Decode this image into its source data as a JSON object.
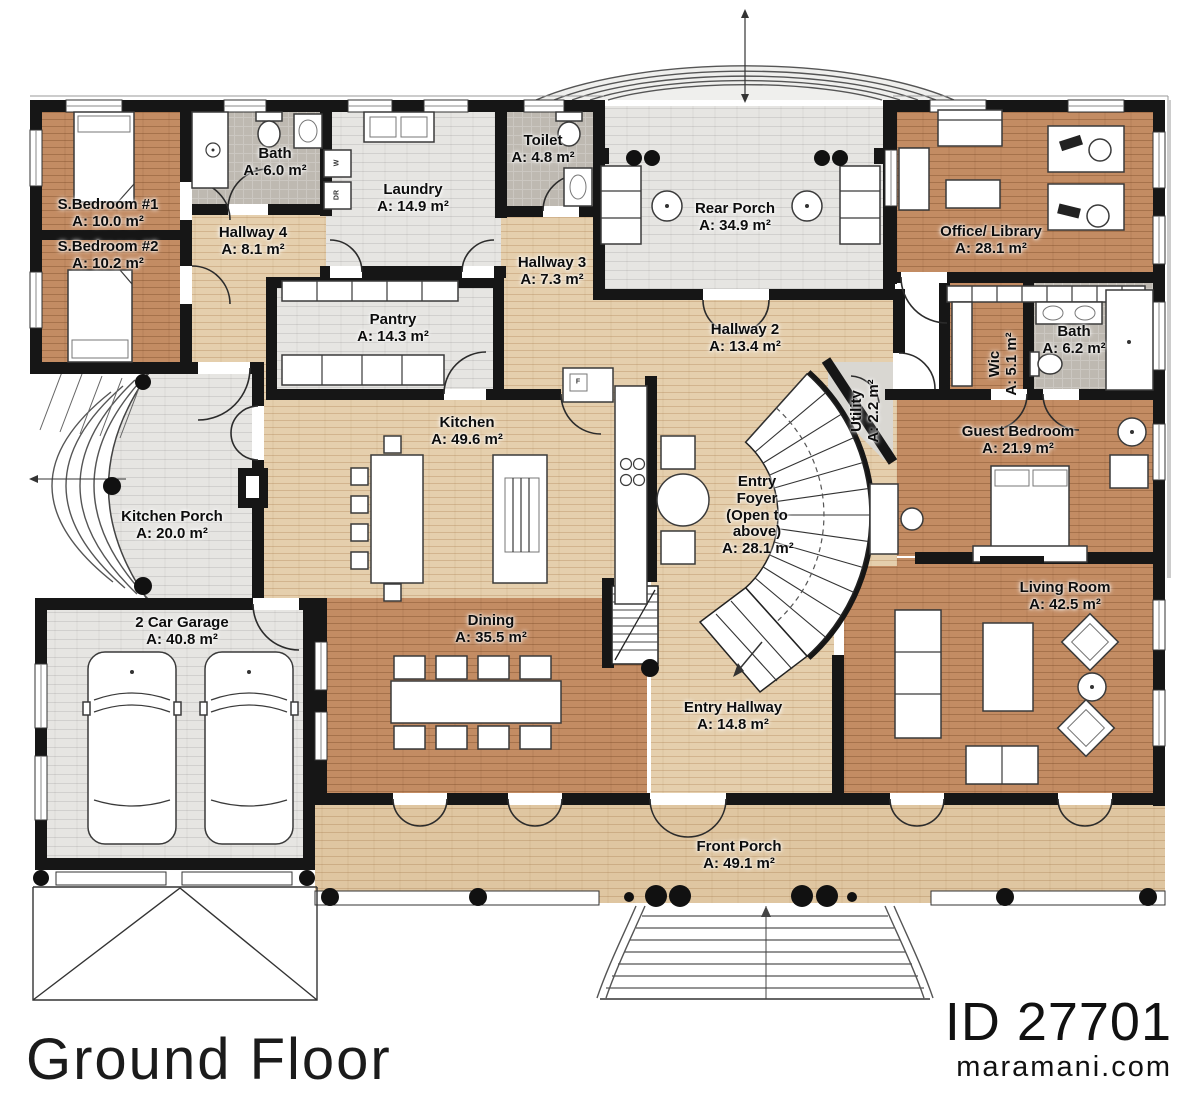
{
  "footer": {
    "title": "Ground Floor",
    "plan_id": "ID 27701",
    "website": "maramani.com"
  },
  "rooms": {
    "s_bedroom_1": {
      "name": "S.Bedroom #1",
      "area": "A: 10.0 m²"
    },
    "s_bedroom_2": {
      "name": "S.Bedroom #2",
      "area": "A: 10.2 m²"
    },
    "bath_1": {
      "name": "Bath",
      "area": "A: 6.0 m²"
    },
    "hallway_4": {
      "name": "Hallway 4",
      "area": "A: 8.1 m²"
    },
    "laundry": {
      "name": "Laundry",
      "area": "A: 14.9 m²"
    },
    "toilet": {
      "name": "Toilet",
      "area": "A: 4.8 m²"
    },
    "hallway_3": {
      "name": "Hallway 3",
      "area": "A: 7.3 m²"
    },
    "pantry": {
      "name": "Pantry",
      "area": "A: 14.3 m²"
    },
    "rear_porch": {
      "name": "Rear Porch",
      "area": "A: 34.9 m²"
    },
    "hallway_2": {
      "name": "Hallway 2",
      "area": "A: 13.4 m²"
    },
    "office_library": {
      "name": "Office/ Library",
      "area": "A: 28.1 m²"
    },
    "bath_2": {
      "name": "Bath",
      "area": "A: 6.2 m²"
    },
    "wic": {
      "name": "Wic",
      "area": "A: 5.1 m²"
    },
    "utility": {
      "name": "Utility",
      "area": "A: 2.2 m²"
    },
    "guest_bedroom": {
      "name": "Guest Bedroom",
      "area": "A: 21.9 m²"
    },
    "kitchen": {
      "name": "Kitchen",
      "area": "A: 49.6 m²"
    },
    "entry_foyer": {
      "name": "Entry Foyer",
      "note": "(Open to above)",
      "area": "A: 28.1 m²"
    },
    "kitchen_porch": {
      "name": "Kitchen Porch",
      "area": "A: 20.0 m²"
    },
    "garage": {
      "name": "2 Car Garage",
      "area": "A: 40.8 m²"
    },
    "dining": {
      "name": "Dining",
      "area": "A: 35.5 m²"
    },
    "entry_hallway": {
      "name": "Entry Hallway",
      "area": "A: 14.8 m²"
    },
    "living_room": {
      "name": "Living Room",
      "area": "A: 42.5 m²"
    },
    "front_porch": {
      "name": "Front Porch",
      "area": "A: 49.1 m²"
    }
  },
  "appliances": {
    "washer": "W",
    "dryer": "DR",
    "fridge": "F"
  },
  "colors": {
    "wall": "#161616",
    "wood_dark": "#c38c63",
    "wood_light": "#e5cfad",
    "porch_wood": "#dfc6a1",
    "porch_brick": "#e6e5e2",
    "bath_gray": "#beb9b1"
  }
}
